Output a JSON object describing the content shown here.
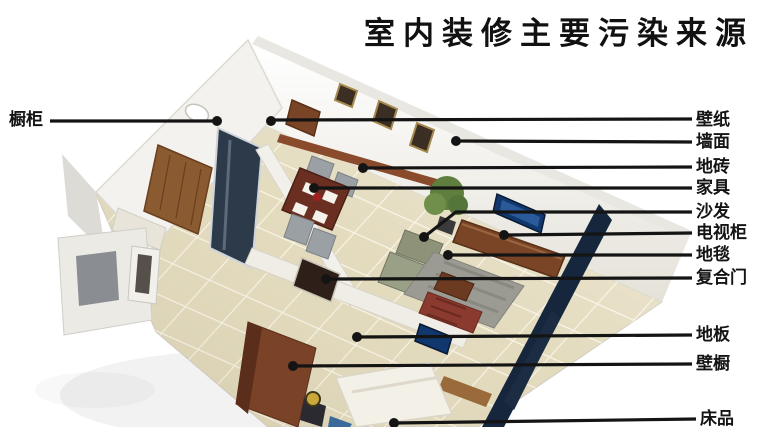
{
  "title": "室内装修主要污染来源",
  "labels": {
    "cabinet": "橱柜",
    "wallpaper": "壁纸",
    "wall_surface": "墙面",
    "floor_tile": "地砖",
    "furniture": "家具",
    "sofa": "沙发",
    "tv_cabinet": "电视柜",
    "carpet": "地毯",
    "composite_door": "复合门",
    "wood_floor": "地板",
    "closet": "壁橱",
    "bedding": "床品"
  },
  "colors": {
    "bg-color": "#ffffff",
    "line-color": "#141414",
    "label-color": "#141414",
    "title-color": "#111111",
    "floor-tile": "#e2d9ba",
    "wood-brown": "#7a4526",
    "dark-wall": "#16263c",
    "tv-screen": "#10386e",
    "plant-green": "#5f7f3f",
    "carpet-gray": "#9b9b93",
    "bed-white": "#f2efe7"
  }
}
